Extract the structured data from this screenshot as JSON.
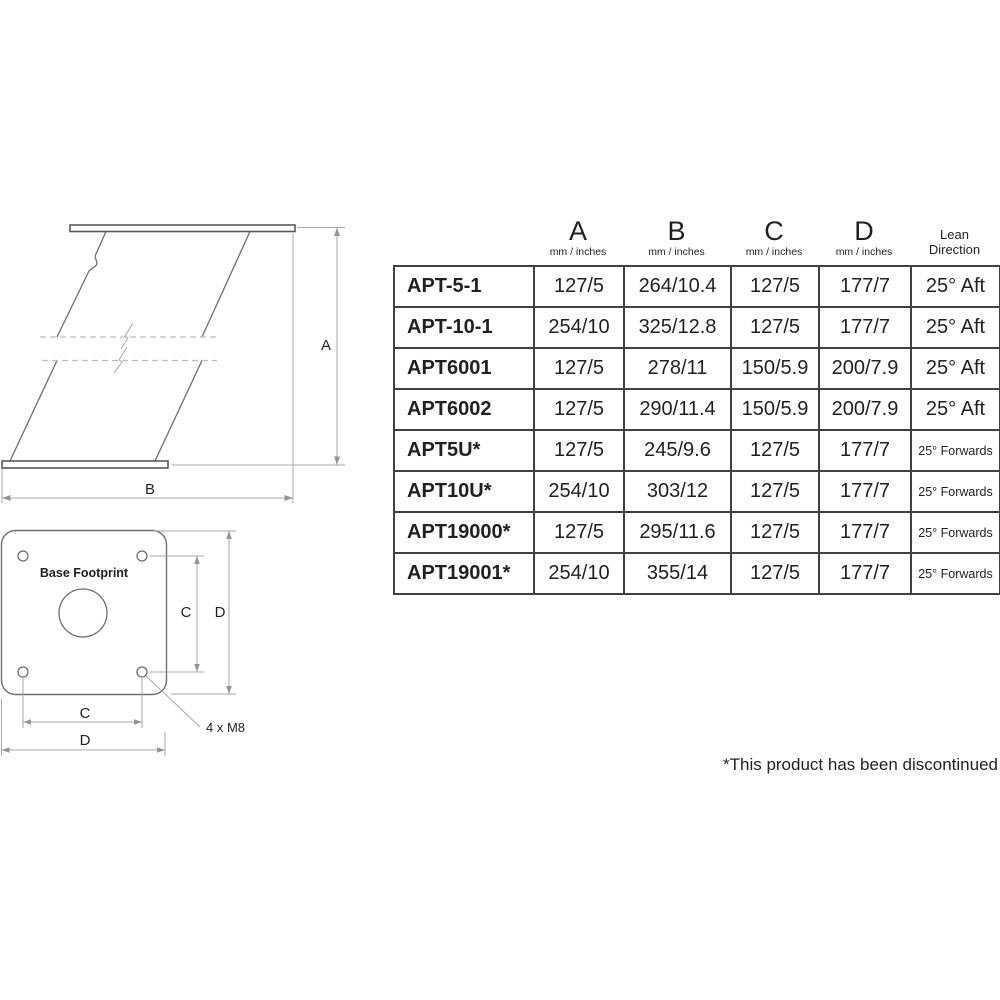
{
  "side_view_diagram": {
    "height_dim_label": "A",
    "depth_dim_label": "B"
  },
  "base_footprint_diagram": {
    "title": "Base Footprint",
    "bolt_spacing_vertical_label": "C",
    "plate_height_label": "D",
    "bolt_spacing_horizontal_label": "C",
    "plate_width_label": "D",
    "bolt_spec_label": "4 x M8"
  },
  "spec_table": {
    "columns": [
      {
        "letter": "A",
        "unit": "mm / inches"
      },
      {
        "letter": "B",
        "unit": "mm / inches"
      },
      {
        "letter": "C",
        "unit": "mm / inches"
      },
      {
        "letter": "D",
        "unit": "mm / inches"
      },
      {
        "line1": "Lean",
        "line2": "Direction"
      }
    ],
    "rows": [
      {
        "model": "APT-5-1",
        "a": "127/5",
        "b": "264/10.4",
        "c": "127/5",
        "d": "177/7",
        "lean": "25° Aft"
      },
      {
        "model": "APT-10-1",
        "a": "254/10",
        "b": "325/12.8",
        "c": "127/5",
        "d": "177/7",
        "lean": "25° Aft"
      },
      {
        "model": "APT6001",
        "a": "127/5",
        "b": "278/11",
        "c": "150/5.9",
        "d": "200/7.9",
        "lean": "25° Aft"
      },
      {
        "model": "APT6002",
        "a": "127/5",
        "b": "290/11.4",
        "c": "150/5.9",
        "d": "200/7.9",
        "lean": "25° Aft"
      },
      {
        "model": "APT5U*",
        "a": "127/5",
        "b": "245/9.6",
        "c": "127/5",
        "d": "177/7",
        "lean": "25° Forwards"
      },
      {
        "model": "APT10U*",
        "a": "254/10",
        "b": "303/12",
        "c": "127/5",
        "d": "177/7",
        "lean": "25° Forwards"
      },
      {
        "model": "APT19000*",
        "a": "127/5",
        "b": "295/11.6",
        "c": "127/5",
        "d": "177/7",
        "lean": "25° Forwards"
      },
      {
        "model": "APT19001*",
        "a": "254/10",
        "b": "355/14",
        "c": "127/5",
        "d": "177/7",
        "lean": "25° Forwards"
      }
    ]
  },
  "footnote": "*This product has been discontinued"
}
